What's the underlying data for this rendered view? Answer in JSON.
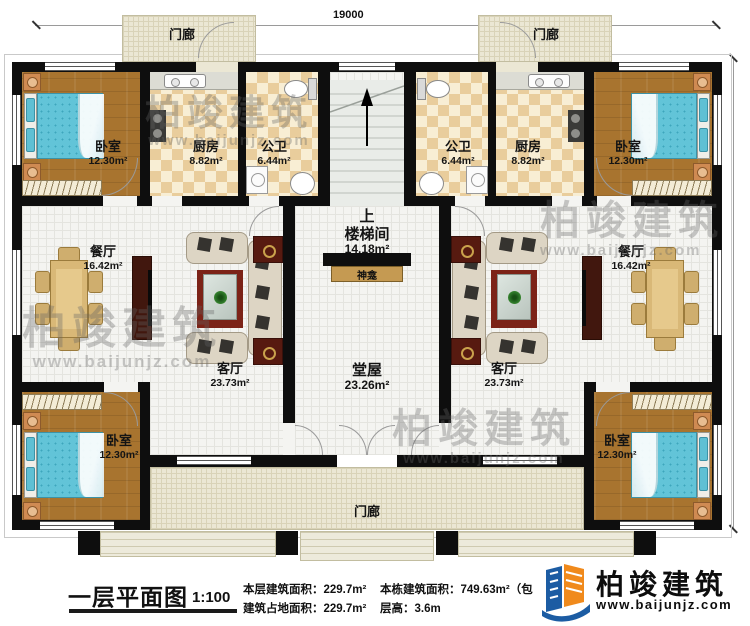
{
  "dimensions": {
    "top": "19000",
    "right": "12600"
  },
  "rooms": {
    "porch": "门廊",
    "bedroom": {
      "name": "卧室",
      "area": "12.30m²"
    },
    "kitchen": {
      "name": "厨房",
      "area": "8.82m²"
    },
    "bathroom": {
      "name": "公卫",
      "area": "6.44m²"
    },
    "dining": {
      "name": "餐厅",
      "area": "16.42m²"
    },
    "living": {
      "name": "客厅",
      "area": "23.73m²"
    },
    "stairwell": {
      "name": "楼梯间",
      "area": "14.18m²"
    },
    "hall": {
      "name": "堂屋",
      "area": "23.26m²"
    },
    "shrine": "神龛",
    "stairs_up": "上"
  },
  "footer": {
    "title": "一层平面图",
    "scale": "1:100",
    "stats": [
      {
        "label": "本层建筑面积：",
        "value": "229.7m²"
      },
      {
        "label": "建筑占地面积：",
        "value": "229.7m²"
      },
      {
        "label": "本栋建筑面积：",
        "value": "749.63m²（包"
      },
      {
        "label": "层高：",
        "value": "3.6m"
      }
    ]
  },
  "logo": {
    "name": "柏竣建筑",
    "website": "www.baijunjz.com"
  },
  "watermark": {
    "name": "柏竣建筑",
    "website": "www.baijunjz.com"
  },
  "colors": {
    "wall": "#0e0e0e",
    "wood_floor": "#a8742f",
    "kitchen_tile": "#e9cd9c",
    "porch": "#ebe7d4",
    "bed": "#62c4d8",
    "shrine_bar": "#c59a52",
    "logo_blue": "#1c5ca3",
    "logo_orange": "#f08a1c"
  }
}
